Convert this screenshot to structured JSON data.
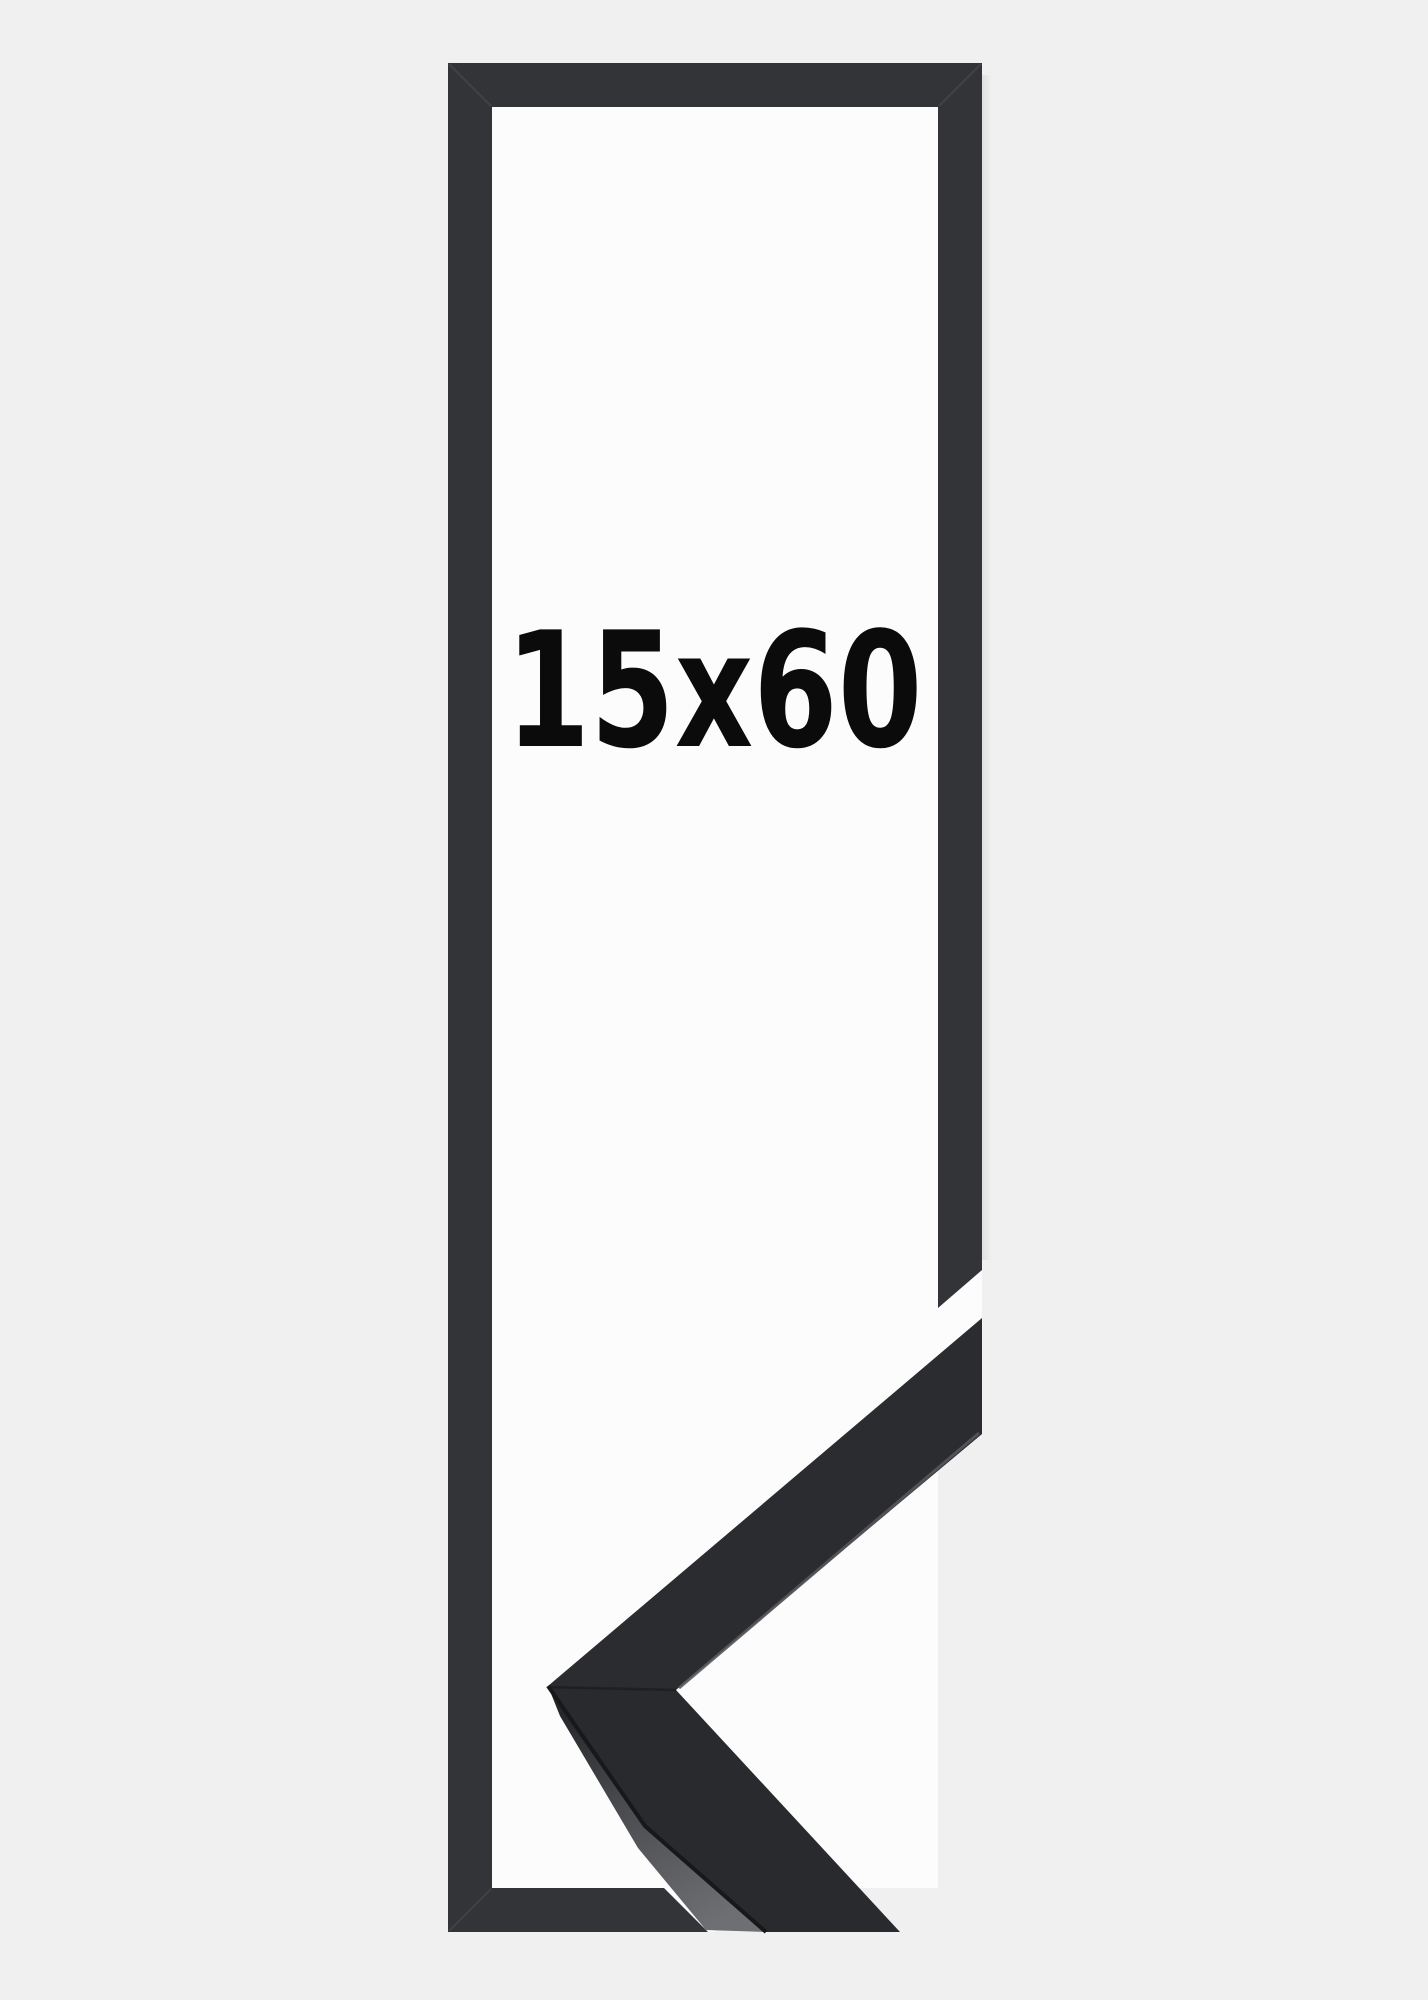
{
  "product": {
    "size_label": "15x60"
  },
  "colors": {
    "background": "#f0f0f1",
    "inner_background": "#fcfcfd",
    "frame_outline": "#333438",
    "moulding_face_upper": "#2b2c2f",
    "moulding_face_lower": "#292a2d",
    "moulding_side_dark": "#26272a",
    "moulding_side_mid": "#4a4b4e",
    "moulding_side_light": "#6e6f72",
    "label_text": "#0b0b0c"
  }
}
